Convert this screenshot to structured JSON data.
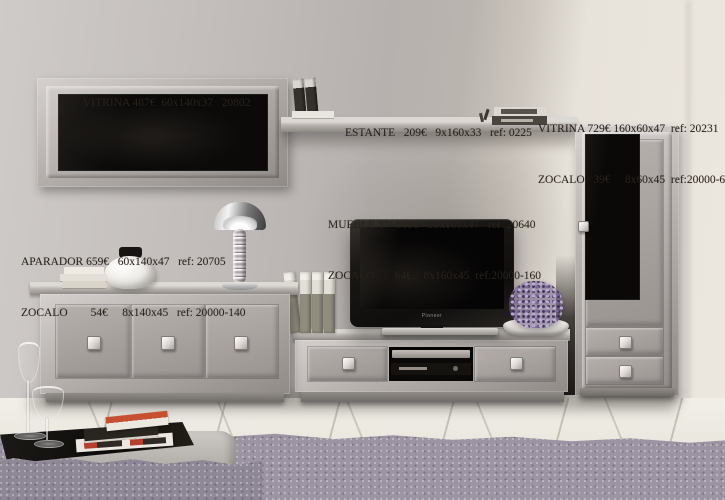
{
  "labels": {
    "wall_vitrina": {
      "line1": "VITRINA 487€  60x140x37   20802"
    },
    "estante": {
      "line1": "ESTANTE   209€   9x160x33   ref: 0225"
    },
    "tall_vitrina": {
      "line1": "VITRINA 729€ 160x60x47  ref: 20231",
      "line2": "ZOCALO   39€     8x60x45  ref:20000-60"
    },
    "mueble_tv": {
      "line1": "MUEBLE TV 569€   35x160x47   ref: 20640",
      "line2": "ZOCALO       64€    8x160x45  ref:20000-160"
    },
    "aparador": {
      "line1": "APARADOR 659€   60x140x47   ref: 20705",
      "line2": "ZOCALO        54€     8x140x45   ref: 20000-140"
    }
  },
  "tv": {
    "brand": "Pioneer"
  },
  "colors": {
    "wall_grey": "#b6b1ae",
    "wall_cream": "#ece7df",
    "furniture_frame": "#b5afac",
    "glass_black": "#0b0a09",
    "floor": "#eae7df",
    "carpet_purple": "#9c94a2",
    "flower_purple": "#8d7ba8",
    "label_text": "#29221b"
  }
}
